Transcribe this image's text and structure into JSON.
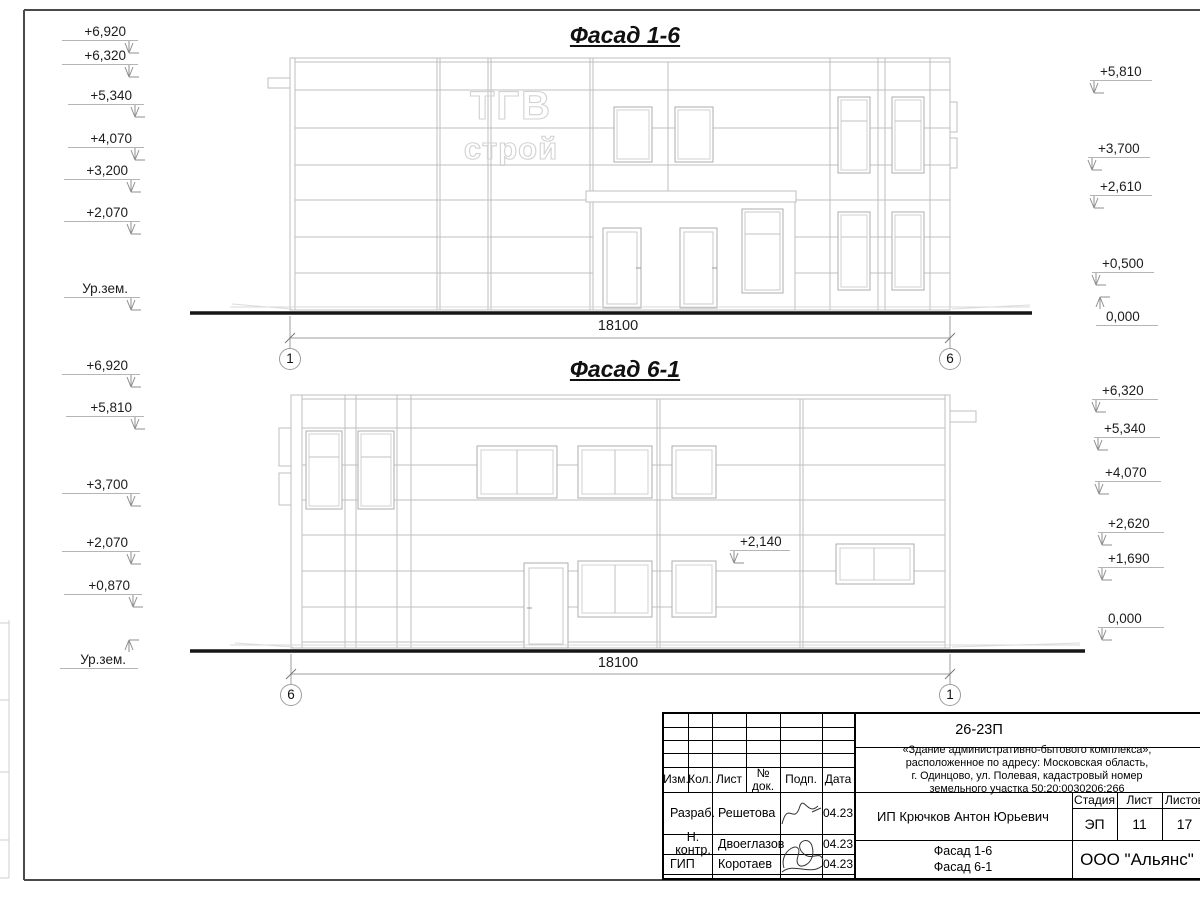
{
  "colors": {
    "linework": "#bfbfbf",
    "ground": "#161616",
    "text": "#1a1a1a",
    "frame": "#4a4a4a"
  },
  "drawing": {
    "facade_top": {
      "title": "Фасад 1-6",
      "sign": {
        "line1": "ТГВ",
        "line2": "строй"
      },
      "dimension": "18100",
      "axis_left": "1",
      "axis_right": "6",
      "marks_left": [
        "+6,920",
        "+6,320",
        "+5,340",
        "+4,070",
        "+3,200",
        "+2,070",
        "Ур.зем."
      ],
      "marks_right": [
        "+5,810",
        "+3,700",
        "+2,610",
        "+0,500",
        "0,000"
      ]
    },
    "facade_bottom": {
      "title": "Фасад 6-1",
      "dimension": "18100",
      "axis_left": "6",
      "axis_right": "1",
      "annotation": "+2,140",
      "marks_left": [
        "+6,920",
        "+5,810",
        "+3,700",
        "+2,070",
        "+0,870",
        "Ур.зем."
      ],
      "marks_right": [
        "+6,320",
        "+5,340",
        "+4,070",
        "+2,620",
        "+1,690",
        "0,000"
      ]
    }
  },
  "title_block": {
    "code": "26-23П",
    "description_lines": [
      "«Здание административно-бытового комплекса»,",
      "расположенное по адресу: Московская область,",
      "г. Одинцово, ул. Полевая, кадастровый номер",
      "земельного участка 50:20:0030206:266"
    ],
    "columns": {
      "izm": "Изм.",
      "kol": "Кол.",
      "list": "Лист",
      "doc": "№ док.",
      "podp": "Подп.",
      "data": "Дата"
    },
    "rows": [
      {
        "role": "Разраб.",
        "name": "Решетова",
        "date": "04.23"
      },
      {
        "role": "Н. контр.",
        "name": "Двоеглазов",
        "date": "04.23"
      },
      {
        "role": "ГИП",
        "name": "Коротаев",
        "date": "04.23"
      }
    ],
    "client": "ИП Крючков Антон Юрьевич",
    "stage_label": "Стадия",
    "sheet_label": "Лист",
    "sheets_label": "Листов",
    "stage": "ЭП",
    "sheet": "11",
    "sheets": "17",
    "sheet_title_line1": "Фасад 1-6",
    "sheet_title_line2": "Фасад 6-1",
    "company": "ООО \"Альянс\""
  }
}
